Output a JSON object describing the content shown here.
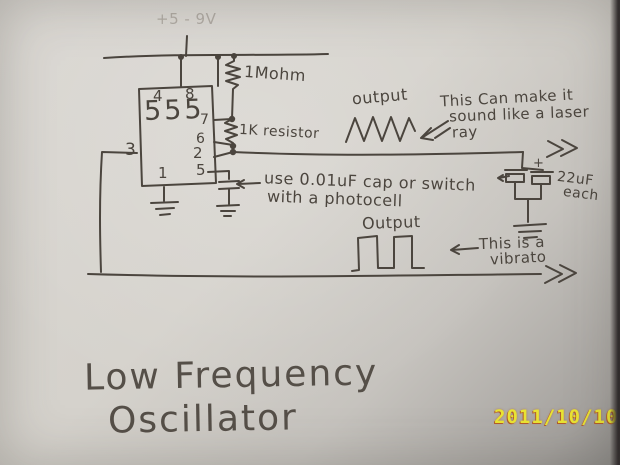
{
  "colors": {
    "ink": "#4b453e",
    "paper": "#d5d2cc",
    "date_yellow": "#eae433",
    "date_shadow": "#b35c2a"
  },
  "supply": {
    "label": "+5 - 9V"
  },
  "ic": {
    "name": "555",
    "pin4": "4",
    "pin8": "8",
    "pin7": "7",
    "pin6": "6",
    "pin2": "2",
    "pin5": "5",
    "pin3": "3",
    "pin1": "1"
  },
  "components": {
    "r1": "1Mohm",
    "r2": "1K resistor",
    "caps_value": "22uF",
    "caps_qty": "each",
    "cap_plus": "+"
  },
  "notes": {
    "cap_line1": "use 0.01uF cap or switch",
    "cap_line2": "with a photocell",
    "laser_line1": "This Can make it",
    "laser_line2": "sound like a laser",
    "laser_line3": "ray",
    "vibrato_line1": "This is a",
    "vibrato_line2": "vibrato"
  },
  "waveforms": {
    "triangle_label": "output",
    "square_label": "Output"
  },
  "title": {
    "line1": "Low Frequency",
    "line2": "Oscillator"
  },
  "camera": {
    "date_stamp": "2011/10/10"
  }
}
